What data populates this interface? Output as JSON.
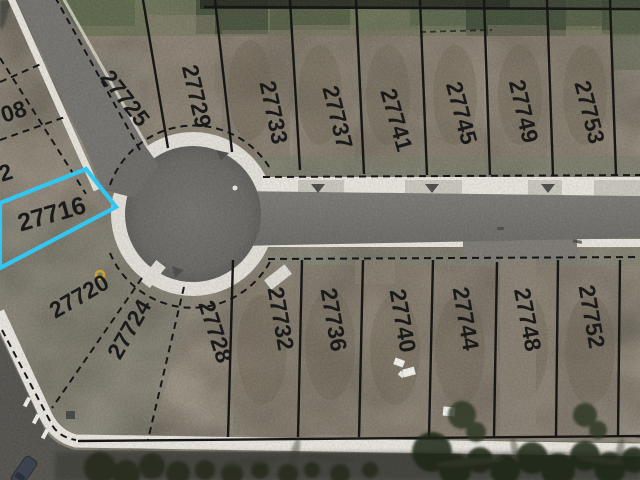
{
  "map": {
    "selected_parcel": "27716",
    "colors": {
      "highlight": "#32c7f2",
      "parcel_line": "#161616",
      "label": "#1a1a1a",
      "marker": "#c8a133"
    },
    "parcels": {
      "top_row": [
        "27725",
        "27729",
        "27733",
        "27737",
        "27741",
        "27745",
        "27749",
        "27753"
      ],
      "left_column": [
        "08",
        "2",
        "27716"
      ],
      "bottom_row": [
        "27720",
        "27724",
        "27728",
        "27732",
        "27736",
        "27740",
        "27744",
        "27748",
        "27752"
      ]
    }
  }
}
